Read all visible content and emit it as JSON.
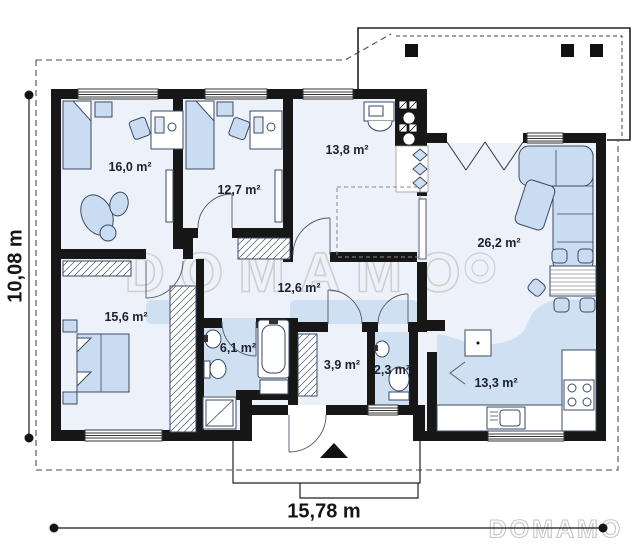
{
  "plan": {
    "title": "single-storey house floor plan",
    "rooms": [
      {
        "id": "bedroom-1",
        "area": "16,0 m²"
      },
      {
        "id": "bedroom-2",
        "area": "12,7 m²"
      },
      {
        "id": "utility",
        "area": "13,8 m²"
      },
      {
        "id": "living-room",
        "area": "26,2 m²"
      },
      {
        "id": "bedroom-3",
        "area": "15,6 m²"
      },
      {
        "id": "hall",
        "area": "12,6 m²"
      },
      {
        "id": "bathroom",
        "area": "6,1 m²"
      },
      {
        "id": "vestibule",
        "area": "3,9 m²"
      },
      {
        "id": "wc",
        "area": "2,3 m²"
      },
      {
        "id": "kitchen",
        "area": "13,3 m²"
      }
    ],
    "dimensions": {
      "height": "10,08 m",
      "width": "15,78 m"
    },
    "watermark": {
      "center": "DOMAMO",
      "corner": "DOMAMO"
    },
    "colors": {
      "wall": "#171717",
      "floor": "#edf2fa",
      "floor_accent": "#cfe0f2",
      "furniture": "#c9dcf1",
      "outline": "#3b4a63",
      "watermark": "#cfcfcf"
    }
  }
}
